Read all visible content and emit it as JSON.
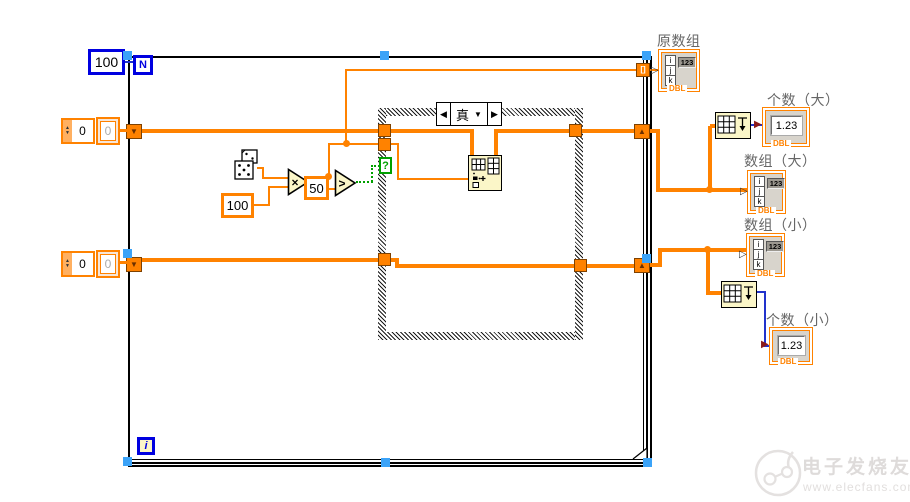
{
  "for_loop": {
    "count_constant": "100",
    "count_terminal": "N",
    "iteration_terminal": "i"
  },
  "array_constants": {
    "top_index": "0",
    "top_element": "0",
    "bottom_index": "0",
    "bottom_element": "0"
  },
  "math": {
    "multiplier_constant": "100",
    "threshold_constant": "50",
    "multiply_symbol": "×",
    "greater_symbol": ">"
  },
  "case_structure": {
    "selector_value": "真",
    "selector_terminal": "?",
    "prev_glyph": "◀",
    "next_glyph": "▶",
    "dropdown_glyph": "▼"
  },
  "glyphs": {
    "shift_register_down": "▼",
    "shift_register_up": "▲",
    "spinner_up": "▲",
    "spinner_down": "▼",
    "autoindex_tunnel": "[]",
    "array_input_arrow": "▷",
    "numeric_input_arrow": "▶"
  },
  "indicators": {
    "original_array": {
      "label": "原数组",
      "digits": "123",
      "dtype": "DBL",
      "idx": [
        "i",
        "j",
        "k"
      ]
    },
    "count_large": {
      "label": "个数（大）",
      "value": "1.23",
      "dtype": "DBL"
    },
    "array_large": {
      "label": "数组（大）",
      "digits": "123",
      "dtype": "DBL",
      "idx": [
        "i",
        "j",
        "k"
      ]
    },
    "array_small": {
      "label": "数组（小）",
      "digits": "123",
      "dtype": "DBL",
      "idx": [
        "i",
        "j",
        "k"
      ]
    },
    "count_small": {
      "label": "个数（小）",
      "value": "1.23",
      "dtype": "DBL"
    }
  },
  "watermark": {
    "brand": "电子发烧友",
    "url": "www.elecfans.com"
  },
  "colors": {
    "wire_orange": "#FF8200",
    "wire_blue": "#2233CC",
    "boolean_green": "#00A000",
    "structure_blue": "#0000E0",
    "selection_handle": "#3BA3F8"
  }
}
